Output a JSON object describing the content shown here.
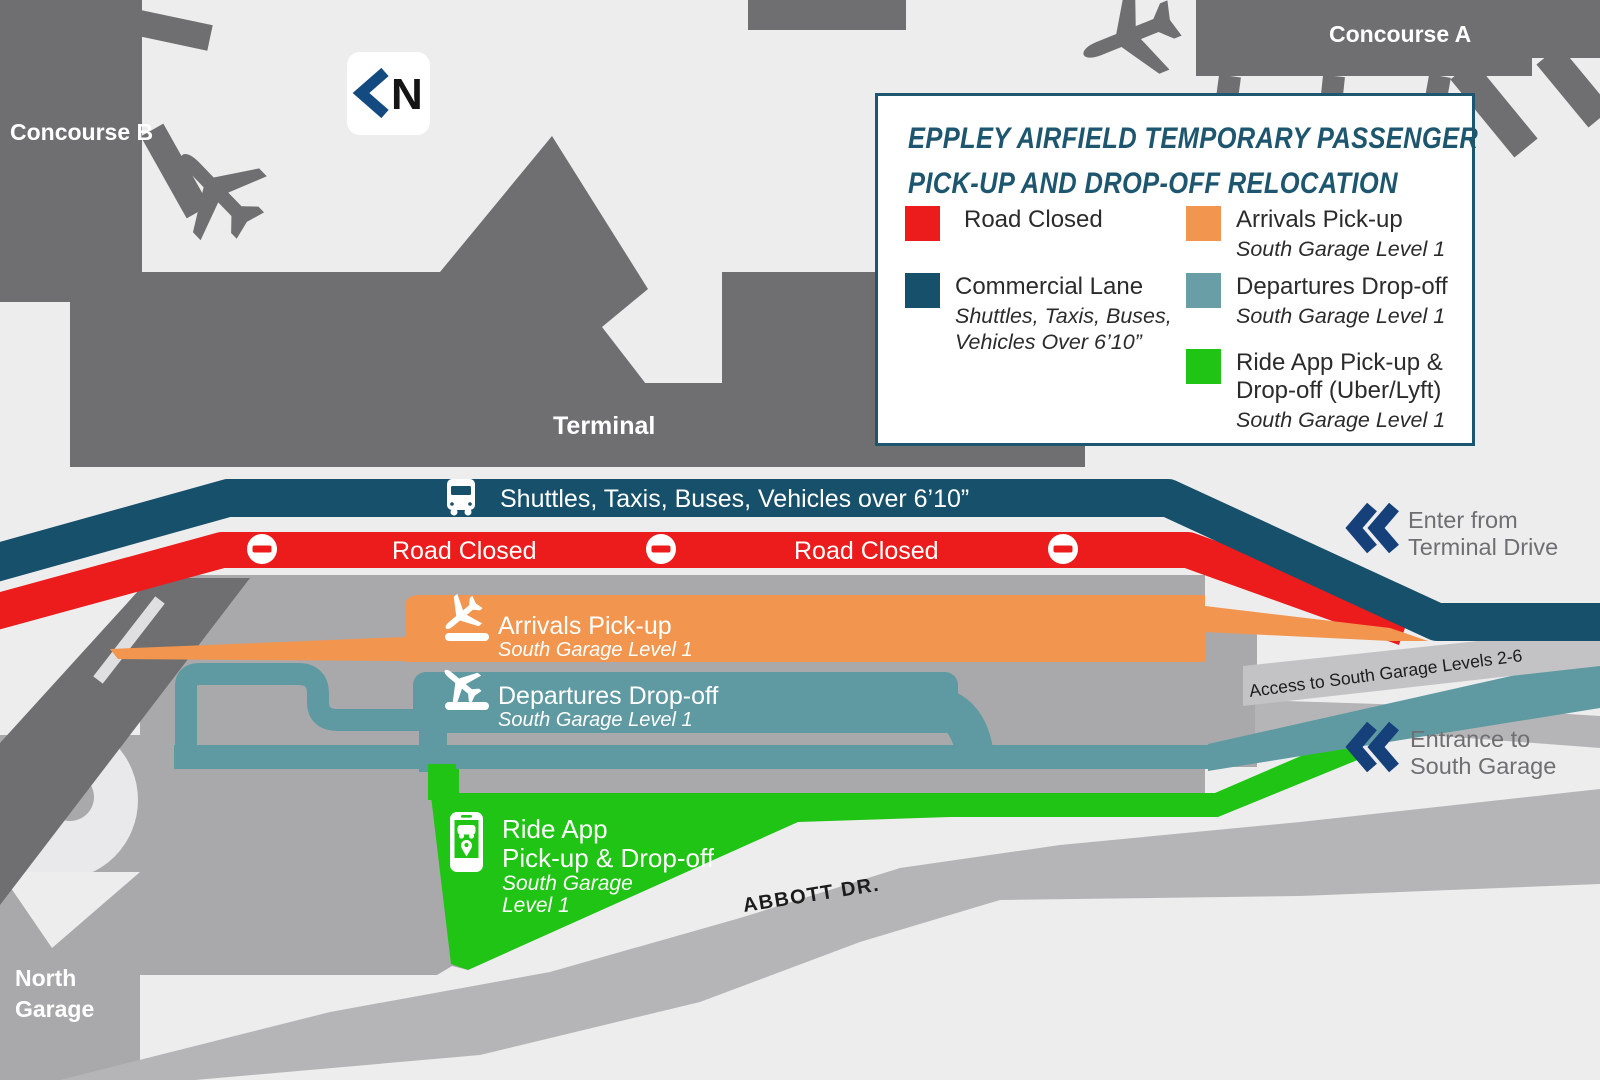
{
  "map": {
    "concourse_a": "Concourse A",
    "concourse_b": "Concourse B",
    "terminal": "Terminal",
    "north_garage_line1": "North",
    "north_garage_line2": "Garage",
    "north_indicator": "N"
  },
  "legend": {
    "title_line1": "EPPLEY AIRFIELD TEMPORARY PASSENGER",
    "title_line2": "PICK-UP AND DROP-OFF RELOCATION",
    "items": [
      {
        "id": "road-closed",
        "swatch_color": "#ec1c1c",
        "label": "Road Closed",
        "sublabel": ""
      },
      {
        "id": "commercial-lane",
        "swatch_color": "#17506b",
        "label": "Commercial Lane",
        "sublabel": "Shuttles, Taxis, Buses, Vehicles Over 6’10”"
      },
      {
        "id": "arrivals-pickup",
        "swatch_color": "#f2954f",
        "label": "Arrivals Pick-up",
        "sublabel": "South Garage Level 1"
      },
      {
        "id": "departures-dropoff",
        "swatch_color": "#699ea6",
        "label": "Departures Drop-off",
        "sublabel": "South Garage Level 1"
      },
      {
        "id": "ride-app",
        "swatch_color": "#1fc414",
        "label": "Ride App Pick-up & Drop-off (Uber/Lyft)",
        "sublabel": "South Garage Level 1"
      }
    ]
  },
  "roads": {
    "commercial_label": "Shuttles, Taxis, Buses, Vehicles over 6’10”",
    "road_closed_label": "Road Closed",
    "arrivals_label": "Arrivals Pick-up",
    "arrivals_sublabel": "South Garage Level 1",
    "departures_label": "Departures Drop-off",
    "departures_sublabel": "South Garage Level 1",
    "ride_app_line1": "Ride App",
    "ride_app_line2": "Pick-up & Drop-off",
    "ride_app_sub1": "South Garage",
    "ride_app_sub2": "Level 1"
  },
  "annotations": {
    "enter_line1": "Enter from",
    "enter_line2": "Terminal Drive",
    "access": "Access to South Garage Levels 2-6",
    "entrance_line1": "Entrance to",
    "entrance_line2": "South Garage",
    "abbott": "ABBOTT DR."
  },
  "colors": {
    "background": "#ededee",
    "building": "#6f6f71",
    "garage": "#a9a9ab",
    "road": "#b5b5b7",
    "road_light": "#c3c3c5",
    "commercial": "#17506b",
    "road_closed": "#ec1c1c",
    "arrivals": "#f2954f",
    "departures": "#5f9aa2",
    "ride_app": "#1fc414",
    "navy_chevron": "#16407a",
    "legend_accent": "#1d566e",
    "annotation_text": "#6f6f71"
  }
}
